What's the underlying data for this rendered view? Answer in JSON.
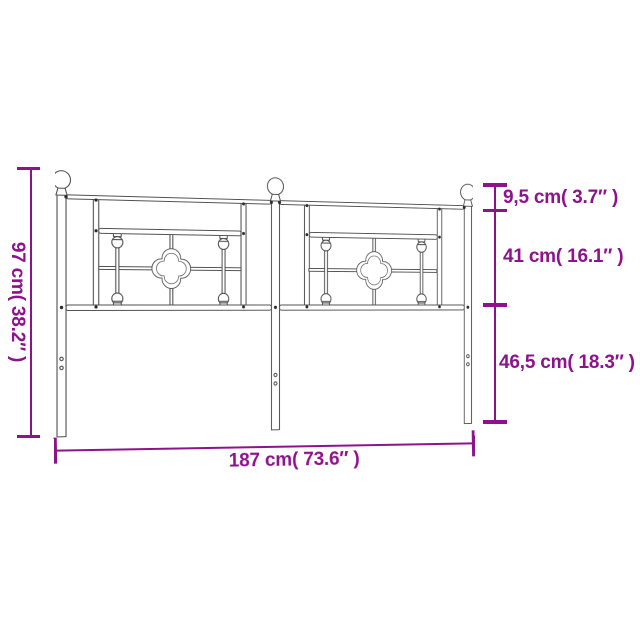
{
  "diagram": {
    "type": "product-dimension-diagram",
    "subject": "metal-headboard",
    "labels": {
      "left": "97 cm( 38.2″ )",
      "right_top": "9,5 cm( 3.7″ )",
      "right_middle": "41 cm( 16.1″ )",
      "right_bottom": "46,5 cm( 18.3″ )",
      "bottom": "187 cm( 73.6″ )"
    },
    "colors": {
      "dimension_accent": "#8E128C",
      "drawing_line": "#4F4F4F",
      "background": "#FFFFFF"
    }
  }
}
